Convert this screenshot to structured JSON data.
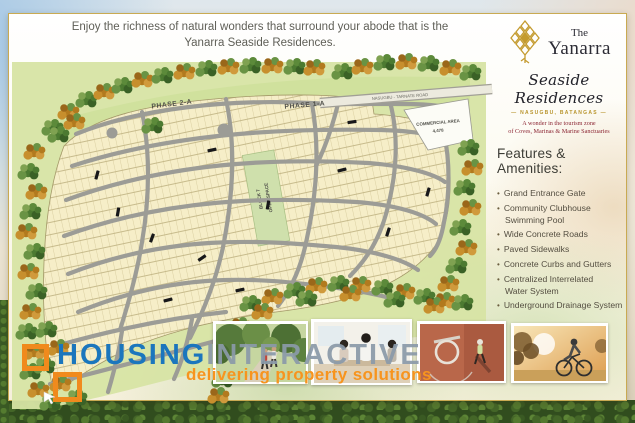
{
  "header": {
    "line1": "Enjoy the richness of natural wonders that surround your abode that is the",
    "line2": "Yanarra Seaside Residences."
  },
  "logo": {
    "the": "The",
    "name": "Yanarra",
    "script": "Seaside Residences",
    "dash": "—",
    "location": "NASUGBU, BATANGAS",
    "tagline_line1": "A wonder in the tourism zone",
    "tagline_line2": "of Coves, Marinas & Marine Sanctuaries"
  },
  "amenities": {
    "heading": "Features & Amenities:",
    "items": [
      {
        "line1": "Grand Entrance Gate",
        "line2": ""
      },
      {
        "line1": "Community Clubhouse",
        "line2": "Swimming Pool"
      },
      {
        "line1": "Wide Concrete Roads",
        "line2": ""
      },
      {
        "line1": "Paved Sidewalks",
        "line2": ""
      },
      {
        "line1": "Concrete Curbs and Gutters",
        "line2": ""
      },
      {
        "line1": "Centralized Interrelated",
        "line2": "Water System"
      },
      {
        "line1": "Underground Drainage System",
        "line2": ""
      }
    ]
  },
  "site_map": {
    "phase_2_label": "PHASE 2-A",
    "phase_1_label": "PHASE 1-A",
    "road_label": "NASUGBU - TARNATE ROAD",
    "commercial_area_line1": "COMMERCIAL AREA",
    "commercial_area_line2": "4,478",
    "open_space_line1": "BLOCK 7",
    "open_space_line2": "OPEN SPACE"
  },
  "watermark": {
    "brand_word1": "HOUSING",
    "brand_word2": "INTERACTIVE",
    "tagline": "delivering property solutions"
  },
  "photos": [
    {
      "alt": "couple jogging in tree-lined park"
    },
    {
      "alt": "family preparing food in kitchen"
    },
    {
      "alt": "aerial view of basketball court dunk"
    },
    {
      "alt": "man riding bicycle at sunset"
    }
  ],
  "colors": {
    "gold_border": "#c9aa52",
    "logo_gold": "#c49b2f",
    "brand_blue": "#1b76bd",
    "brand_orange": "#f7941e",
    "maroon_text": "#8c2633"
  }
}
